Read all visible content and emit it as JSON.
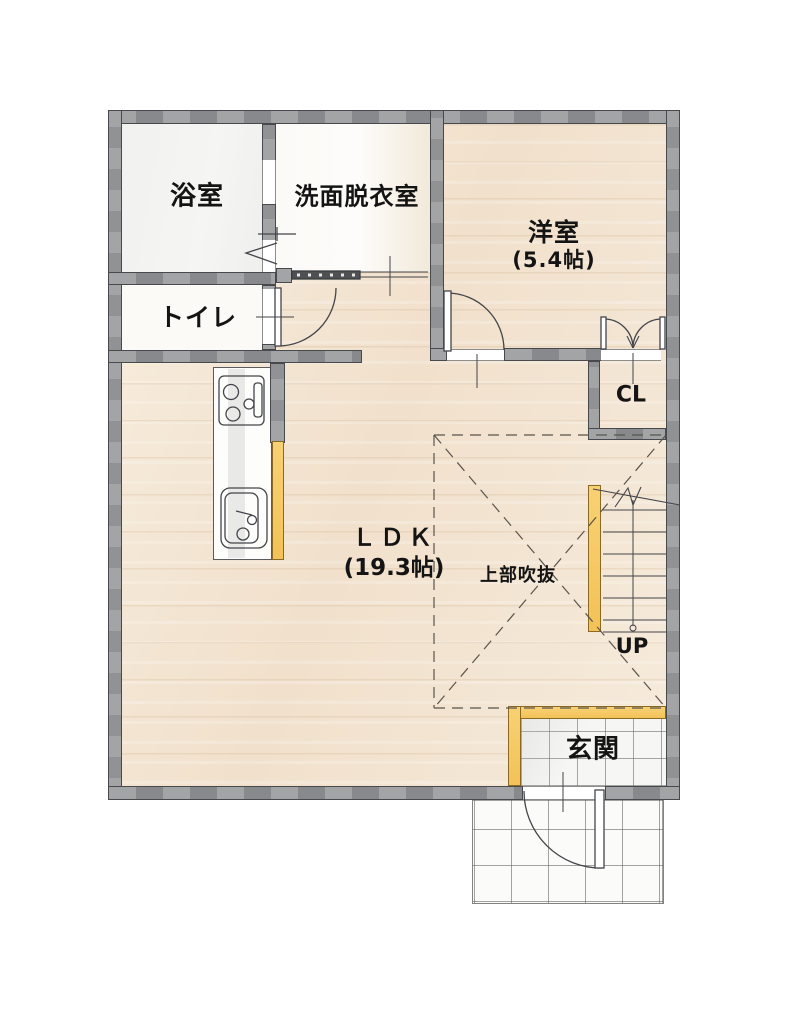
{
  "floorplan": {
    "title": "1F floor plan",
    "rooms": {
      "bath": {
        "label": "浴室"
      },
      "washroom": {
        "label": "洗面脱衣室"
      },
      "toilet": {
        "label": "トイレ"
      },
      "western_room": {
        "label": "洋室",
        "size": "(5.4帖)"
      },
      "closet": {
        "label": "CL"
      },
      "ldk": {
        "label": "ＬＤＫ",
        "size": "(19.3帖)"
      },
      "void_above": {
        "label": "上部吹抜"
      },
      "stairs": {
        "label": "UP"
      },
      "entrance": {
        "label": "玄関"
      }
    },
    "colors": {
      "wall_gray": "#8b8d90",
      "wood_floor": "#f2e4d2",
      "accent_yellow": "#f6c863",
      "tile_white": "#f6f6f4",
      "line_dark": "#43454a"
    }
  }
}
